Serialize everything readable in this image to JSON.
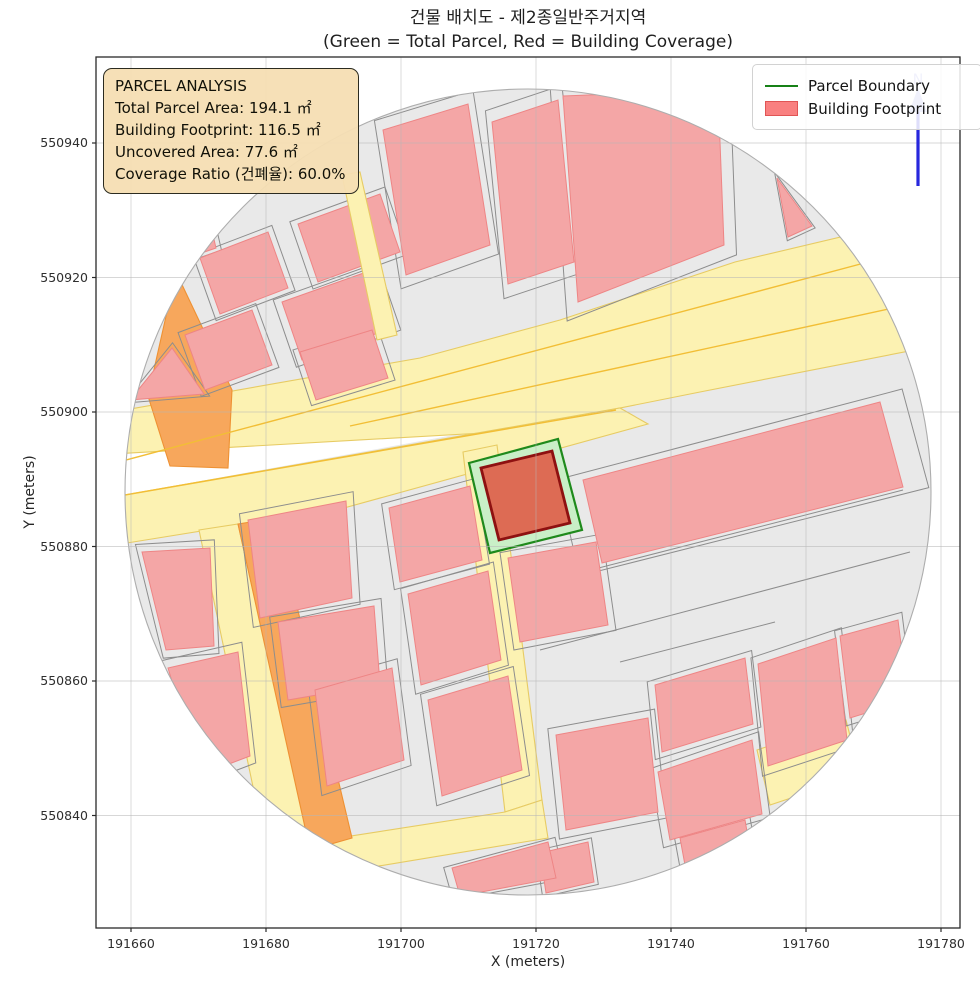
{
  "title": {
    "line1": "건물 배치도 - 제2종일반주거지역",
    "line2": "(Green = Total Parcel, Red = Building Coverage)"
  },
  "info_box": {
    "heading": "PARCEL ANALYSIS",
    "line1": "Total Parcel Area: 194.1 ㎡",
    "line2": "Building Footprint: 116.5 ㎡",
    "line3": "Uncovered Area: 77.6 ㎡",
    "line4": "Coverage Ratio (건폐율): 60.0%"
  },
  "legend": {
    "items": [
      {
        "label": "Parcel Boundary",
        "swatch": "green-line",
        "color": "#178117"
      },
      {
        "label": "Building Footprint",
        "swatch": "red-patch",
        "color": "#f98080"
      }
    ]
  },
  "axes": {
    "x_label": "X (meters)",
    "y_label": "Y (meters)",
    "x_ticks": [
      {
        "label": "191660",
        "px": 131
      },
      {
        "label": "191680",
        "px": 266
      },
      {
        "label": "191700",
        "px": 401
      },
      {
        "label": "191720",
        "px": 536
      },
      {
        "label": "191740",
        "px": 671
      },
      {
        "label": "191760",
        "px": 806
      },
      {
        "label": "191780",
        "px": 941
      }
    ],
    "y_ticks": [
      {
        "label": "550940",
        "px": 143
      },
      {
        "label": "550920",
        "px": 277.5
      },
      {
        "label": "550900",
        "px": 412
      },
      {
        "label": "550880",
        "px": 546.5
      },
      {
        "label": "550860",
        "px": 681
      },
      {
        "label": "550840",
        "px": 815.5
      }
    ],
    "x_range": [
      191655,
      191783
    ],
    "y_range": [
      550827,
      550950
    ]
  },
  "plot_area": {
    "left": 96,
    "top": 57,
    "right": 960,
    "bottom": 928
  },
  "north_arrow": {
    "label": "N",
    "x": 918,
    "line_y1": 112,
    "line_y2": 186,
    "head": "909,112 927,112 918,88",
    "label_y": 84
  },
  "map": {
    "colors": {
      "base": "#e9e9e9",
      "parcel_line": "#8d8d8d",
      "circle_edge": "#adadad",
      "building_fill": "#f4a6a6",
      "building_edge": "#ee8585",
      "road_fill": "#fcf2b2",
      "road_edge": "#e7cb63",
      "lane_line": "#f2be35",
      "orange_fill": "#f7a75c",
      "orange_edge": "#ee9133",
      "parcel_green_fill": "#c9efc7",
      "parcel_green_edge": "#1f8a1c",
      "target_building_fill": "#dd6b54",
      "target_building_edge": "#8e1111",
      "grid": "rgba(183,183,183,0.55)",
      "frame": "#2a2a2a",
      "arrow_blue": "#2727dd",
      "arrow_faint": "#99a0ea",
      "white": "#ffffff"
    },
    "clip_circle": {
      "cx": 528,
      "cy": 492,
      "r": 403
    },
    "white_wedges": [
      [
        96,
        455,
        614,
        406,
        96,
        500
      ]
    ],
    "roads": [
      {
        "kind": "yellow",
        "pts": [
          96,
          415,
          420,
          358,
          560,
          320,
          735,
          262,
          870,
          230,
          915,
          262,
          938,
          308,
          940,
          345,
          700,
          392,
          500,
          432,
          96,
          455
        ]
      },
      {
        "kind": "yellow",
        "pts": [
          96,
          500,
          620,
          408,
          648,
          424,
          344,
          508,
          96,
          548
        ]
      },
      {
        "kind": "yellow",
        "pts": [
          463,
          452,
          497,
          445,
          542,
          800,
          505,
          812
        ]
      },
      {
        "kind": "yellow",
        "pts": [
          505,
          812,
          542,
          800,
          548,
          838,
          258,
          886,
          248,
          852
        ]
      },
      {
        "kind": "yellow",
        "pts": [
          757,
          750,
          846,
          720,
          860,
          775,
          770,
          805
        ]
      },
      {
        "kind": "yellow",
        "pts": [
          199,
          530,
          238,
          524,
          310,
          845,
          268,
          858
        ]
      },
      {
        "kind": "orange",
        "pts": [
          238,
          524,
          276,
          518,
          352,
          838,
          310,
          850
        ]
      },
      {
        "kind": "orange",
        "pts": [
          176,
          272,
          232,
          390,
          228,
          468,
          170,
          466,
          148,
          396
        ]
      },
      {
        "kind": "yellow",
        "above": true,
        "pts": [
          342,
          175,
          360,
          172,
          397,
          335,
          377,
          340
        ]
      }
    ],
    "lane_lines": [
      [
        96,
        468,
        868,
        262
      ],
      [
        350,
        426,
        930,
        300
      ],
      [
        96,
        500,
        616,
        410
      ]
    ],
    "extra_parcel_lines": [
      [
        540,
        650,
        910,
        552
      ],
      [
        620,
        662,
        775,
        622
      ],
      [
        583,
        572,
        903,
        490
      ]
    ],
    "buildings": [
      [
        200,
        258,
        268,
        232,
        288,
        288,
        220,
        314
      ],
      [
        298,
        224,
        380,
        194,
        400,
        252,
        318,
        282
      ],
      [
        383,
        130,
        468,
        104,
        490,
        245,
        406,
        275
      ],
      [
        185,
        335,
        252,
        310,
        272,
        365,
        205,
        390
      ],
      [
        282,
        302,
        372,
        270,
        392,
        328,
        302,
        360
      ],
      [
        300,
        352,
        372,
        330,
        388,
        378,
        316,
        400
      ],
      [
        492,
        122,
        558,
        100,
        574,
        262,
        508,
        284
      ],
      [
        563,
        96,
        718,
        90,
        724,
        245,
        578,
        302
      ],
      [
        777,
        178,
        812,
        226,
        788,
        237
      ],
      [
        148,
        222,
        205,
        200,
        216,
        248,
        158,
        268
      ],
      [
        130,
        400,
        172,
        348,
        204,
        394
      ],
      [
        142,
        552,
        210,
        548,
        214,
        646,
        166,
        650
      ],
      [
        168,
        668,
        238,
        652,
        250,
        756,
        200,
        775
      ],
      [
        248,
        520,
        346,
        501,
        352,
        598,
        260,
        618
      ],
      [
        278,
        622,
        374,
        606,
        380,
        684,
        288,
        700
      ],
      [
        315,
        690,
        392,
        668,
        404,
        760,
        327,
        786
      ],
      [
        389,
        508,
        470,
        486,
        482,
        560,
        400,
        582
      ],
      [
        408,
        594,
        488,
        571,
        501,
        660,
        421,
        685
      ],
      [
        428,
        700,
        508,
        676,
        522,
        770,
        442,
        796
      ],
      [
        508,
        558,
        596,
        542,
        608,
        625,
        520,
        642
      ],
      [
        556,
        735,
        648,
        718,
        658,
        812,
        566,
        830
      ],
      [
        655,
        685,
        745,
        658,
        753,
        724,
        662,
        752
      ],
      [
        658,
        772,
        752,
        740,
        762,
        814,
        670,
        840
      ],
      [
        758,
        664,
        836,
        638,
        847,
        740,
        768,
        766
      ],
      [
        840,
        636,
        898,
        620,
        908,
        700,
        850,
        718
      ],
      [
        680,
        838,
        745,
        820,
        752,
        860,
        687,
        876
      ],
      [
        540,
        853,
        588,
        842,
        594,
        882,
        546,
        893
      ],
      [
        583,
        480,
        880,
        402,
        903,
        487,
        602,
        563
      ],
      [
        452,
        868,
        548,
        842,
        556,
        878,
        460,
        896
      ]
    ],
    "special_parcel": {
      "green_pts": [
        469,
        463,
        558,
        439,
        582,
        530,
        490,
        553
      ],
      "building_pts": [
        481,
        468,
        552,
        451,
        570,
        523,
        499,
        540
      ]
    }
  }
}
